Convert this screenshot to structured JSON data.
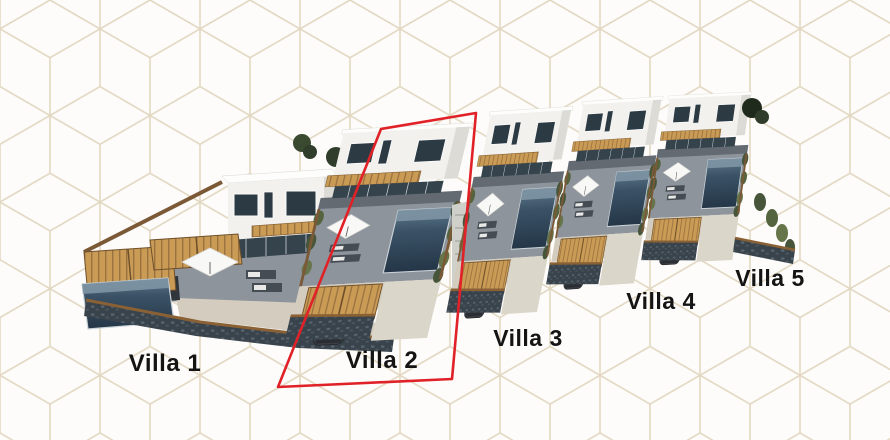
{
  "scene": {
    "kind": "residential-site-plan-render",
    "villa_count": 5
  },
  "villas": [
    {
      "label": "Villa 1",
      "highlighted": false
    },
    {
      "label": "Villa 2",
      "highlighted": true
    },
    {
      "label": "Villa 3",
      "highlighted": false
    },
    {
      "label": "Villa 4",
      "highlighted": false
    },
    {
      "label": "Villa 5",
      "highlighted": false
    }
  ],
  "highlight": {
    "villa_label": "Villa 2",
    "outline_color": "#e02228"
  },
  "colors": {
    "background": "#fdfcfa",
    "pattern_line": "#ddd1b8",
    "label_text": "#141414",
    "highlight_red": "#e02228",
    "house_white": "#f2f1ed",
    "house_shade": "#dcdbd6",
    "window_dark": "#2c3a43",
    "pool_water": "#2e4253",
    "wood_tan": "#c99b55",
    "terrace_gray": "#8e949b",
    "stone_wall": "#39434c",
    "fence_brown": "#7b5936",
    "plant_green": "#53643e",
    "gravel": "#d4cdbf"
  }
}
